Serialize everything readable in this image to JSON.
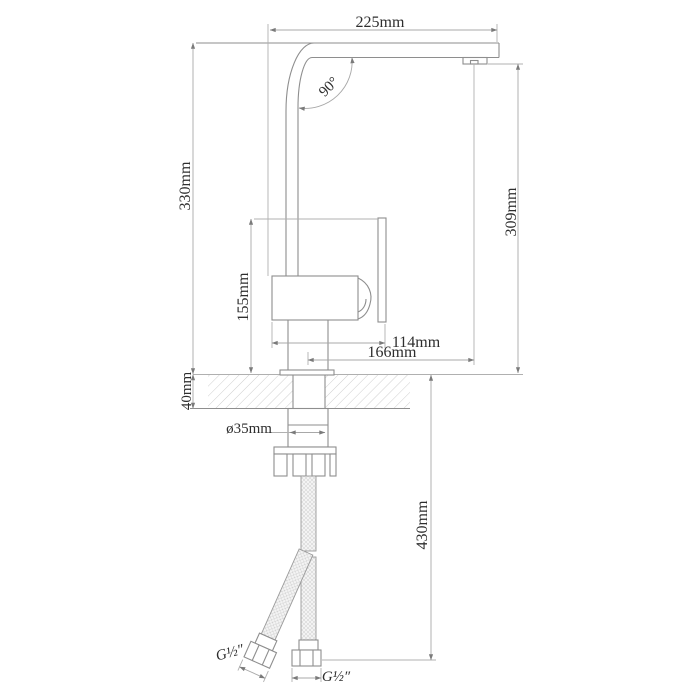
{
  "labels": {
    "spout_length": "225mm",
    "height_left": "330mm",
    "height_right": "309mm",
    "bend_angle": "90°",
    "body_height": "155mm",
    "body_width": "114mm",
    "spout_reach": "166mm",
    "deck_thickness": "40mm",
    "hole_diameter": "ø35mm",
    "hose_length": "430mm",
    "thread_left": "G½″",
    "thread_right": "G½″"
  },
  "colors": {
    "line": "#8e8e8e",
    "dimension": "#a8a8a8",
    "text": "#2e2e2e",
    "hatch": "#cfcfcf",
    "background": "#ffffff"
  }
}
